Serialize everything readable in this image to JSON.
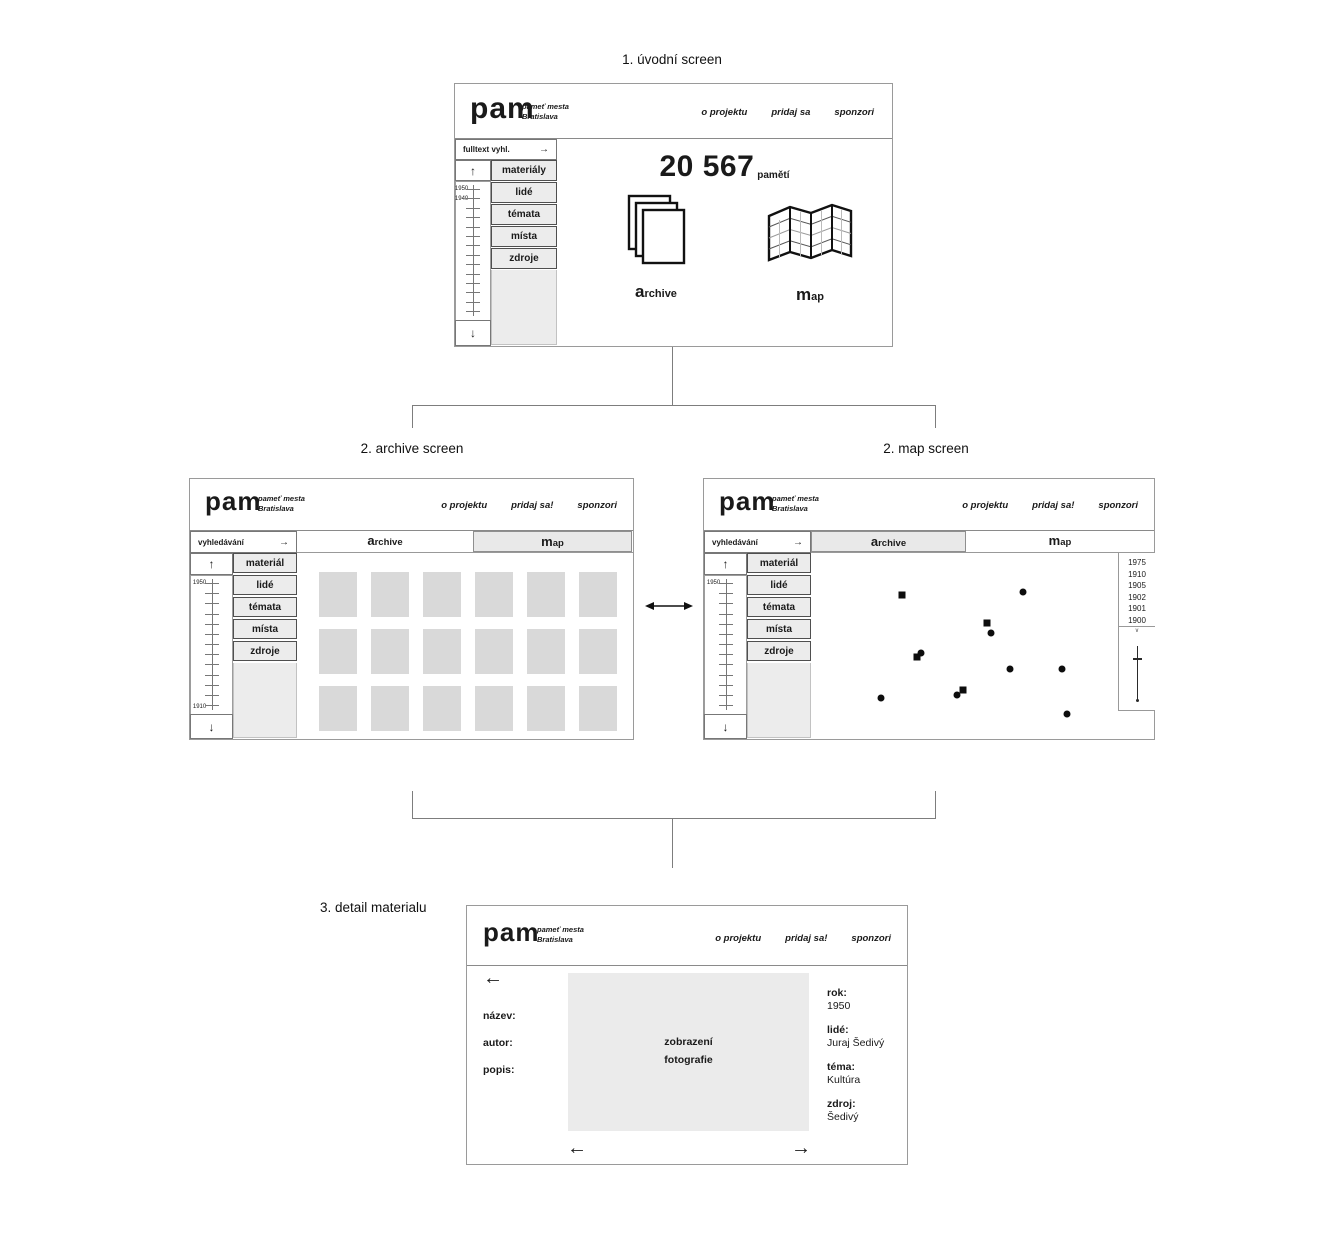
{
  "glyphs": {
    "up": "↑",
    "down": "↓",
    "right_arrow": "→",
    "left_arrow": "←",
    "chevron_down": "∨"
  },
  "colors": {
    "frame": "#9a9a9a",
    "panel_fill": "#ececec",
    "thumb_fill": "#d9d9d9",
    "photo_fill": "#ebebeb",
    "marker": "#0d0d0d",
    "ink": "#1a1a1a"
  },
  "flow": {
    "label_intro": "1. úvodní screen",
    "label_archive": "2. archive screen",
    "label_map": "2. map screen",
    "label_detail": "3. detail materialu"
  },
  "brand": {
    "logo": "pam",
    "tagline1": "pameť mesta",
    "tagline2": "Bratislava"
  },
  "intro": {
    "nav": [
      "o projektu",
      "pridaj sa",
      "sponzori"
    ],
    "search": "fulltext vyhl.",
    "menu": [
      "materiály",
      "lidé",
      "témata",
      "místa",
      "zdroje"
    ],
    "timeline": {
      "top_label": "1950",
      "second_label": "1940"
    },
    "count": "20 567",
    "count_suffix": "pamětí",
    "archive_initial": "a",
    "archive_rest": "rchive",
    "map_initial": "m",
    "map_rest": "ap"
  },
  "archive": {
    "nav": [
      "o projektu",
      "pridaj sa!",
      "sponzori"
    ],
    "search": "vyhledávání",
    "menu": [
      "materiál",
      "lidé",
      "témata",
      "místa",
      "zdroje"
    ],
    "timeline": {
      "top_label": "1950",
      "bottom_label": "1910"
    },
    "tab_archive_initial": "a",
    "tab_archive_rest": "rchive",
    "tab_map_initial": "m",
    "tab_map_rest": "ap",
    "grid": {
      "rows": 3,
      "cols": 6
    }
  },
  "map": {
    "nav": [
      "o projektu",
      "pridaj sa!",
      "sponzori"
    ],
    "search": "vyhledávání",
    "menu": [
      "materiál",
      "lidé",
      "témata",
      "místa",
      "zdroje"
    ],
    "timeline": {
      "top_label": "1950"
    },
    "tab_archive_initial": "a",
    "tab_archive_rest": "rchive",
    "tab_map_initial": "m",
    "tab_map_rest": "ap",
    "years": [
      "1975",
      "1910",
      "1905",
      "1902",
      "1901",
      "1900"
    ],
    "markers": [
      {
        "shape": "square",
        "x": 198,
        "y": 116
      },
      {
        "shape": "square",
        "x": 283,
        "y": 144
      },
      {
        "shape": "square",
        "x": 213,
        "y": 178
      },
      {
        "shape": "square",
        "x": 259,
        "y": 211
      },
      {
        "shape": "dot",
        "x": 319,
        "y": 113
      },
      {
        "shape": "dot",
        "x": 287,
        "y": 154
      },
      {
        "shape": "dot",
        "x": 217,
        "y": 174
      },
      {
        "shape": "dot",
        "x": 306,
        "y": 190
      },
      {
        "shape": "dot",
        "x": 358,
        "y": 190
      },
      {
        "shape": "dot",
        "x": 253,
        "y": 216
      },
      {
        "shape": "dot",
        "x": 177,
        "y": 219
      },
      {
        "shape": "dot",
        "x": 363,
        "y": 235
      }
    ]
  },
  "detail": {
    "nav": [
      "o projektu",
      "pridaj sa!",
      "sponzori"
    ],
    "left_labels": [
      "název:",
      "autor:",
      "popis:"
    ],
    "photo_line1": "zobrazení",
    "photo_line2": "fotografie",
    "fields": [
      {
        "label": "rok:",
        "value": "1950"
      },
      {
        "label": "lidé:",
        "value": "Juraj Šedivý"
      },
      {
        "label": "téma:",
        "value": "Kultúra"
      },
      {
        "label": "zdroj:",
        "value": "Šedivý"
      }
    ]
  }
}
